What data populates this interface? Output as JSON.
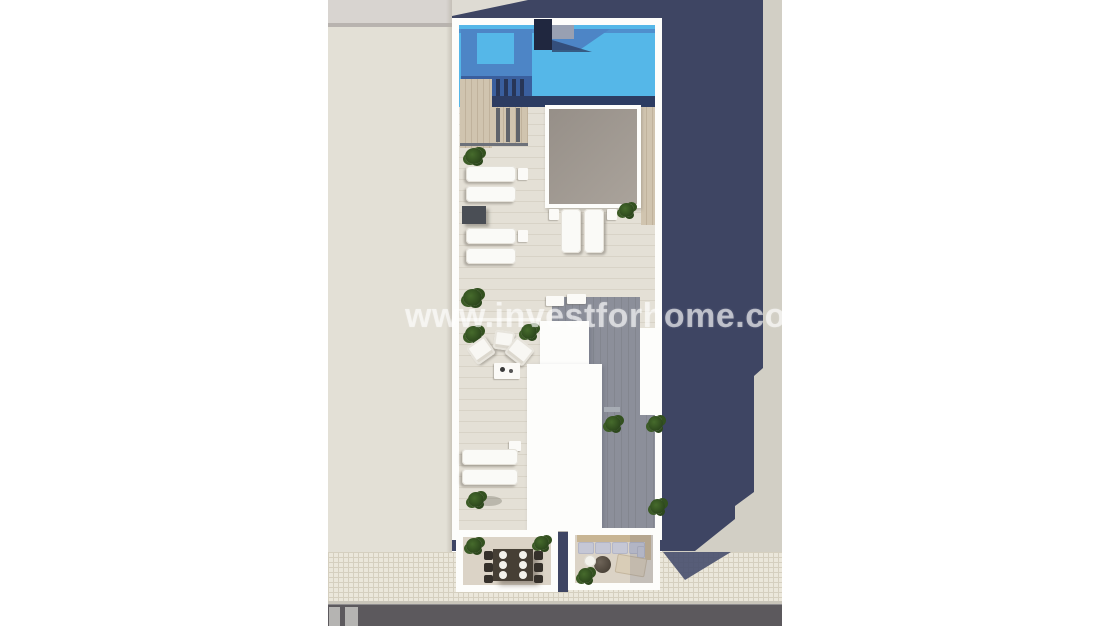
{
  "watermark": {
    "text": "www.investforhome.com"
  },
  "scene": {
    "type": "aerial-3d-architectural-render",
    "subject": "rooftop floor plan of a residential building",
    "features": [
      "rooftop swimming pool",
      "roof chimney block",
      "skylight",
      "sun deck with loungers",
      "lounge seating area with armchairs and coffee table",
      "shaded timber deck",
      "white roof volumes",
      "street-side dining balcony with table for six",
      "street-side balcony with corner sofa and round table",
      "neighboring roof",
      "tiled sidewalk",
      "asphalt road",
      "long cast shadow of the building"
    ]
  },
  "palette": {
    "pool_bright": "#55b7e8",
    "pool_mid": "#4d85c6",
    "pool_deep": "#3a5f9e",
    "pool_edge_band": "#2c3c62",
    "cast_shadow_navy": "#3e4563",
    "building_white": "#fdfdfb",
    "tile_floor_light": "#e4e0d6",
    "deck_shaded_gray": "#8c8f9a",
    "wood_deck": "#d0c4af",
    "skylight_gray": "#a39c94",
    "neighbor_roof_beige": "#e3e0d6",
    "ground_right_gray": "#d2cfc5",
    "sidewalk_beige": "#ebe7db",
    "road_gray": "#5c595d",
    "plant_green": "#35521f",
    "background_white": "#ffffff"
  },
  "inventory": {
    "pools": 1,
    "skylights": 1,
    "sun_loungers": 8,
    "armchairs": 3,
    "coffee_tables": 1,
    "side_tables": 7,
    "dining_tables": 1,
    "dining_chairs": 6,
    "plates": 6,
    "sofa_cushions": 5,
    "round_tables": 1,
    "poufs": 2,
    "daybeds": 1,
    "plants": 12,
    "road_markings": 2
  }
}
